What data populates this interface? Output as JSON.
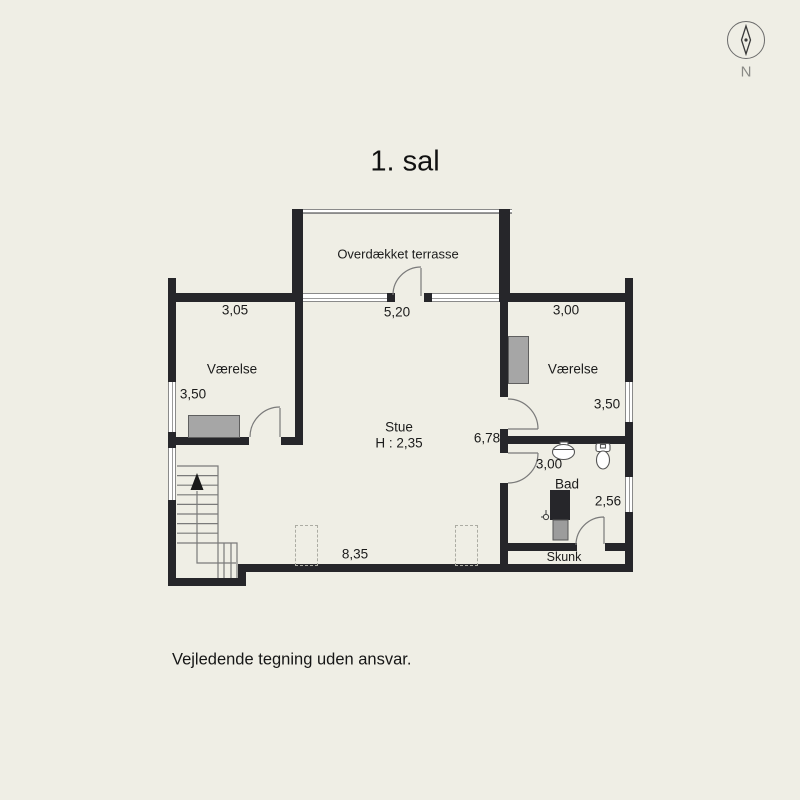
{
  "title": "1. sal",
  "disclaimer": "Vejledende tegning uden ansvar.",
  "compass": {
    "direction_label": "N"
  },
  "colors": {
    "background": "#efeee5",
    "wall": "#26262a",
    "furniture_gray": "#a6a6a6",
    "thin_line_gray": "#7a7a7a"
  },
  "plan": {
    "floor_name": "1. sal",
    "rooms": [
      "Overdækket terrasse",
      "Værelse",
      "Værelse",
      "Stue",
      "Bad",
      "Skunk"
    ],
    "ceiling_height_note": "H : 2,35",
    "labels": [
      {
        "name": "label-terrace",
        "text": "Overdækket terrasse",
        "x": 398,
        "y": 254,
        "size": 13
      },
      {
        "name": "dim-top-left",
        "text": "3,05",
        "x": 235,
        "y": 310,
        "size": 13.5
      },
      {
        "name": "dim-terrace-door",
        "text": "5,20",
        "x": 397,
        "y": 312,
        "size": 13.5
      },
      {
        "name": "dim-top-right",
        "text": "3,00",
        "x": 566,
        "y": 310,
        "size": 13.5
      },
      {
        "name": "label-vaerelse-left",
        "text": "Værelse",
        "x": 232,
        "y": 369,
        "size": 13.5
      },
      {
        "name": "dim-left-window",
        "text": "3,50",
        "x": 193,
        "y": 394,
        "size": 13.5
      },
      {
        "name": "label-vaerelse-right",
        "text": "Værelse",
        "x": 573,
        "y": 369,
        "size": 13.5
      },
      {
        "name": "dim-right-window",
        "text": "3,50",
        "x": 607,
        "y": 404,
        "size": 13.5
      },
      {
        "name": "label-stue",
        "text": "Stue",
        "x": 399,
        "y": 427,
        "size": 13.5
      },
      {
        "name": "label-stue-height",
        "text": "H : 2,35",
        "x": 399,
        "y": 443,
        "size": 13.5
      },
      {
        "name": "dim-stue-width",
        "text": "6,78",
        "x": 487,
        "y": 438,
        "size": 13.5
      },
      {
        "name": "dim-bad-door",
        "text": "3,00",
        "x": 549,
        "y": 464,
        "size": 13.5
      },
      {
        "name": "label-bad",
        "text": "Bad",
        "x": 567,
        "y": 484,
        "size": 13.5
      },
      {
        "name": "dim-bad-window",
        "text": "2,56",
        "x": 608,
        "y": 501,
        "size": 13.5
      },
      {
        "name": "dim-stue-length",
        "text": "8,35",
        "x": 355,
        "y": 554,
        "size": 13.5
      },
      {
        "name": "label-skunk",
        "text": "Skunk",
        "x": 564,
        "y": 557,
        "size": 12.5
      }
    ]
  }
}
